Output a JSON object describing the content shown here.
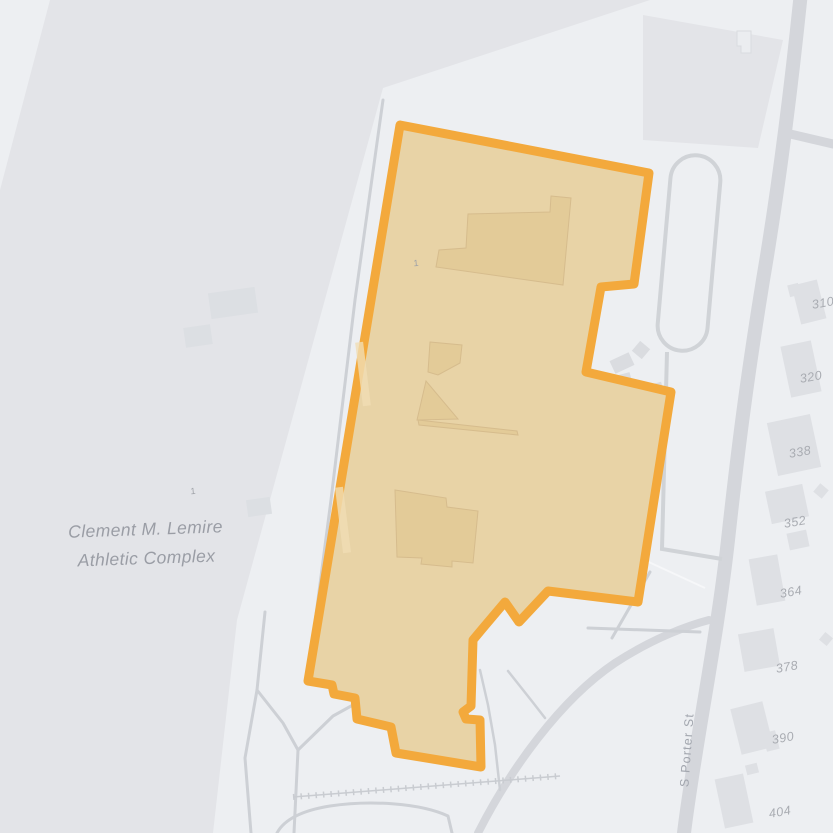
{
  "map": {
    "facility_label": {
      "line1": "Clement M. Lemire",
      "line2": "Athletic Complex"
    },
    "street_label": "S Porter St",
    "house_numbers": [
      {
        "text": "310"
      },
      {
        "text": "320"
      },
      {
        "text": "338"
      },
      {
        "text": "352"
      },
      {
        "text": "364"
      },
      {
        "text": "378"
      },
      {
        "text": "390"
      },
      {
        "text": "404"
      }
    ],
    "small_marks": [
      {
        "text": "1"
      },
      {
        "text": "1"
      }
    ],
    "colors": {
      "parcel_outline": "#F3A93C",
      "parcel_fill": "#E8D3A6",
      "background": "#EDEFF2",
      "field": "#E3E4E8",
      "road": "#D4D6DB",
      "building": "#DEE0E4",
      "house_number_text": "#A9ACB2",
      "facility_text": "#9A9DA5",
      "street_text": "#A2A6AE"
    }
  }
}
